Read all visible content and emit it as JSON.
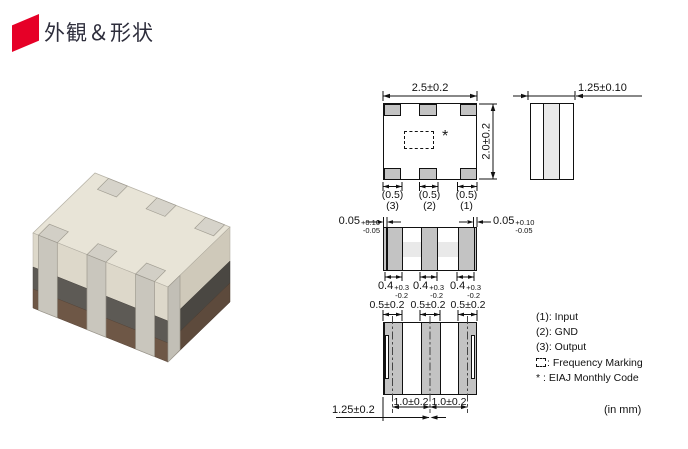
{
  "header": {
    "title": "外観＆形状",
    "accent_color": "#e60027"
  },
  "colors": {
    "line": "#1a1a1a",
    "pad_gray": "#c3c3c3",
    "shading_gray": "#e9e9e9"
  },
  "photo": {
    "description": "smd-component-photo"
  },
  "views": {
    "top_view": {
      "width_dim": "2.5±0.2",
      "height_dim": "2.0±0.2",
      "marking": "*",
      "pad_dims": [
        "(0.5)",
        "(0.5)",
        "(0.5)"
      ],
      "pad_numbers": [
        "(3)",
        "(2)",
        "(1)"
      ]
    },
    "side_view": {
      "width_dim": "1.25±0.10"
    },
    "front_view": {
      "edge_tol": {
        "value": "0.05",
        "plus": "+0.10",
        "minus": "-0.05"
      },
      "terminal_dims": [
        {
          "value": "0.4",
          "plus": "+0.3",
          "minus": "-0.2"
        },
        {
          "value": "0.4",
          "plus": "+0.3",
          "minus": "-0.2"
        },
        {
          "value": "0.4",
          "plus": "+0.3",
          "minus": "-0.2"
        }
      ]
    },
    "bottom_view": {
      "terminal_width_dims": [
        "0.5±0.2",
        "0.5±0.2",
        "0.5±0.2"
      ],
      "pitch_dims": [
        "1.0±0.2",
        "1.0±0.2"
      ],
      "half_width_dim": "1.25±0.2"
    }
  },
  "legend": {
    "items": [
      {
        "prefix": "(1):",
        "label": "Input"
      },
      {
        "prefix": "(2):",
        "label": "GND"
      },
      {
        "prefix": "(3):",
        "label": "Output"
      },
      {
        "prefix": ":",
        "label": "Frequency Marking"
      },
      {
        "prefix": "* :",
        "label": "EIAJ Monthly Code"
      }
    ],
    "unit_note": "(in mm)"
  }
}
